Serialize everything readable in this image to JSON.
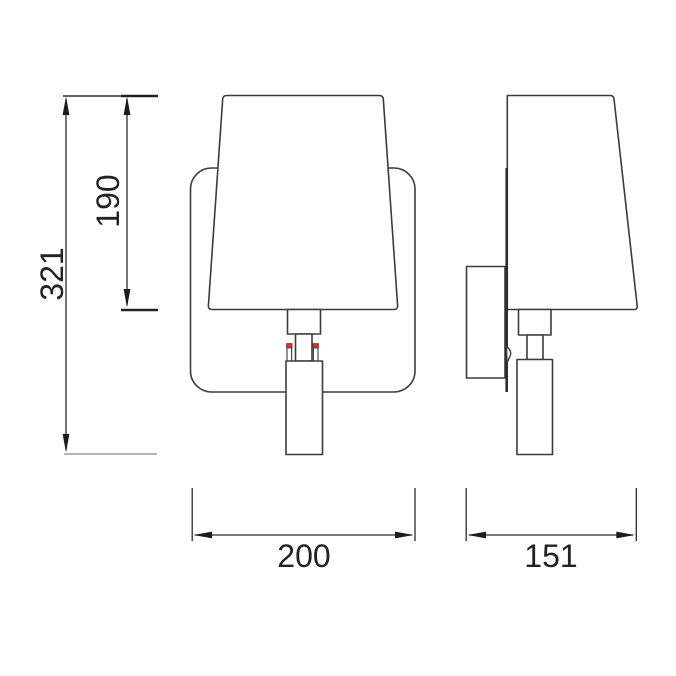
{
  "drawing": {
    "dimensions": {
      "overall_height": "321",
      "shade_height": "190",
      "width": "200",
      "depth": "151"
    },
    "colors": {
      "outline": "#3c3c3c",
      "dimension": "#2a2a2a",
      "accent_red": "#c43a30",
      "background": "#ffffff"
    }
  }
}
